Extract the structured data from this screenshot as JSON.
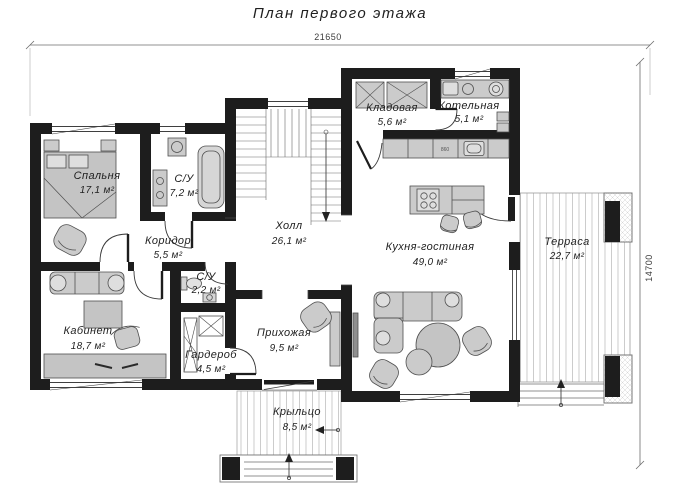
{
  "title": "План первого этажа",
  "dimensions": {
    "width": "21650",
    "height": "14700"
  },
  "rooms": {
    "bedroom": {
      "name": "Спальня",
      "area": "17,1 м²"
    },
    "bath1": {
      "name": "С/У",
      "area": "7,2 м²"
    },
    "corridor": {
      "name": "Коридор",
      "area": "5,5 м²"
    },
    "office": {
      "name": "Кабинет",
      "area": "18,7 м²"
    },
    "bath2": {
      "name": "С/У",
      "area": "2,2 м²"
    },
    "wardrobe": {
      "name": "Гардероб",
      "area": "4,5 м²"
    },
    "hall": {
      "name": "Холл",
      "area": "26,1 м²"
    },
    "pantry": {
      "name": "Кладовая",
      "area": "5,6 м²"
    },
    "boiler": {
      "name": "Котельная",
      "area": "5,1 м²"
    },
    "kitchen": {
      "name": "Кухня-гостиная",
      "area": "49,0 м²"
    },
    "terrace": {
      "name": "Терраса",
      "area": "22,7 м²"
    },
    "entry": {
      "name": "Прихожая",
      "area": "9,5 м²"
    },
    "porch": {
      "name": "Крыльцо",
      "area": "8,5 м²"
    }
  },
  "labels": {
    "counter": "860"
  },
  "colors": {
    "wall": "#1d1d1d",
    "furniture": "#cbcbcb",
    "line": "#555555"
  }
}
